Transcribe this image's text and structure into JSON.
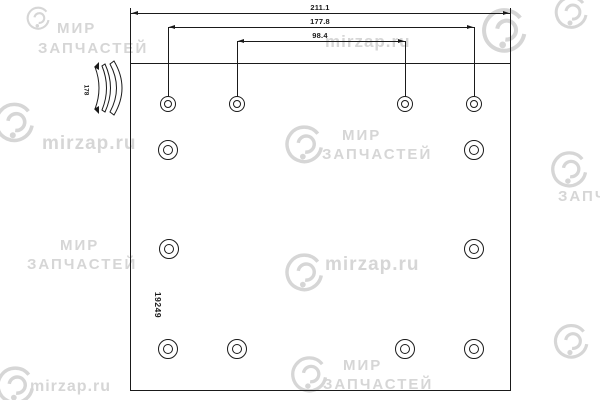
{
  "drawing": {
    "dimensions": {
      "overall": "211.1",
      "outer_holes": "177.8",
      "inner_holes": "98.4",
      "arc_label": "178"
    },
    "part_number": "19249"
  },
  "watermark": {
    "brand_top": "МИР",
    "brand_bottom": "ЗАПЧАСТЕЙ",
    "site": "mirzap.ru"
  },
  "colors": {
    "background": "#ffffff",
    "line": "#1a1a1a",
    "watermark": "#d6d6d6"
  }
}
